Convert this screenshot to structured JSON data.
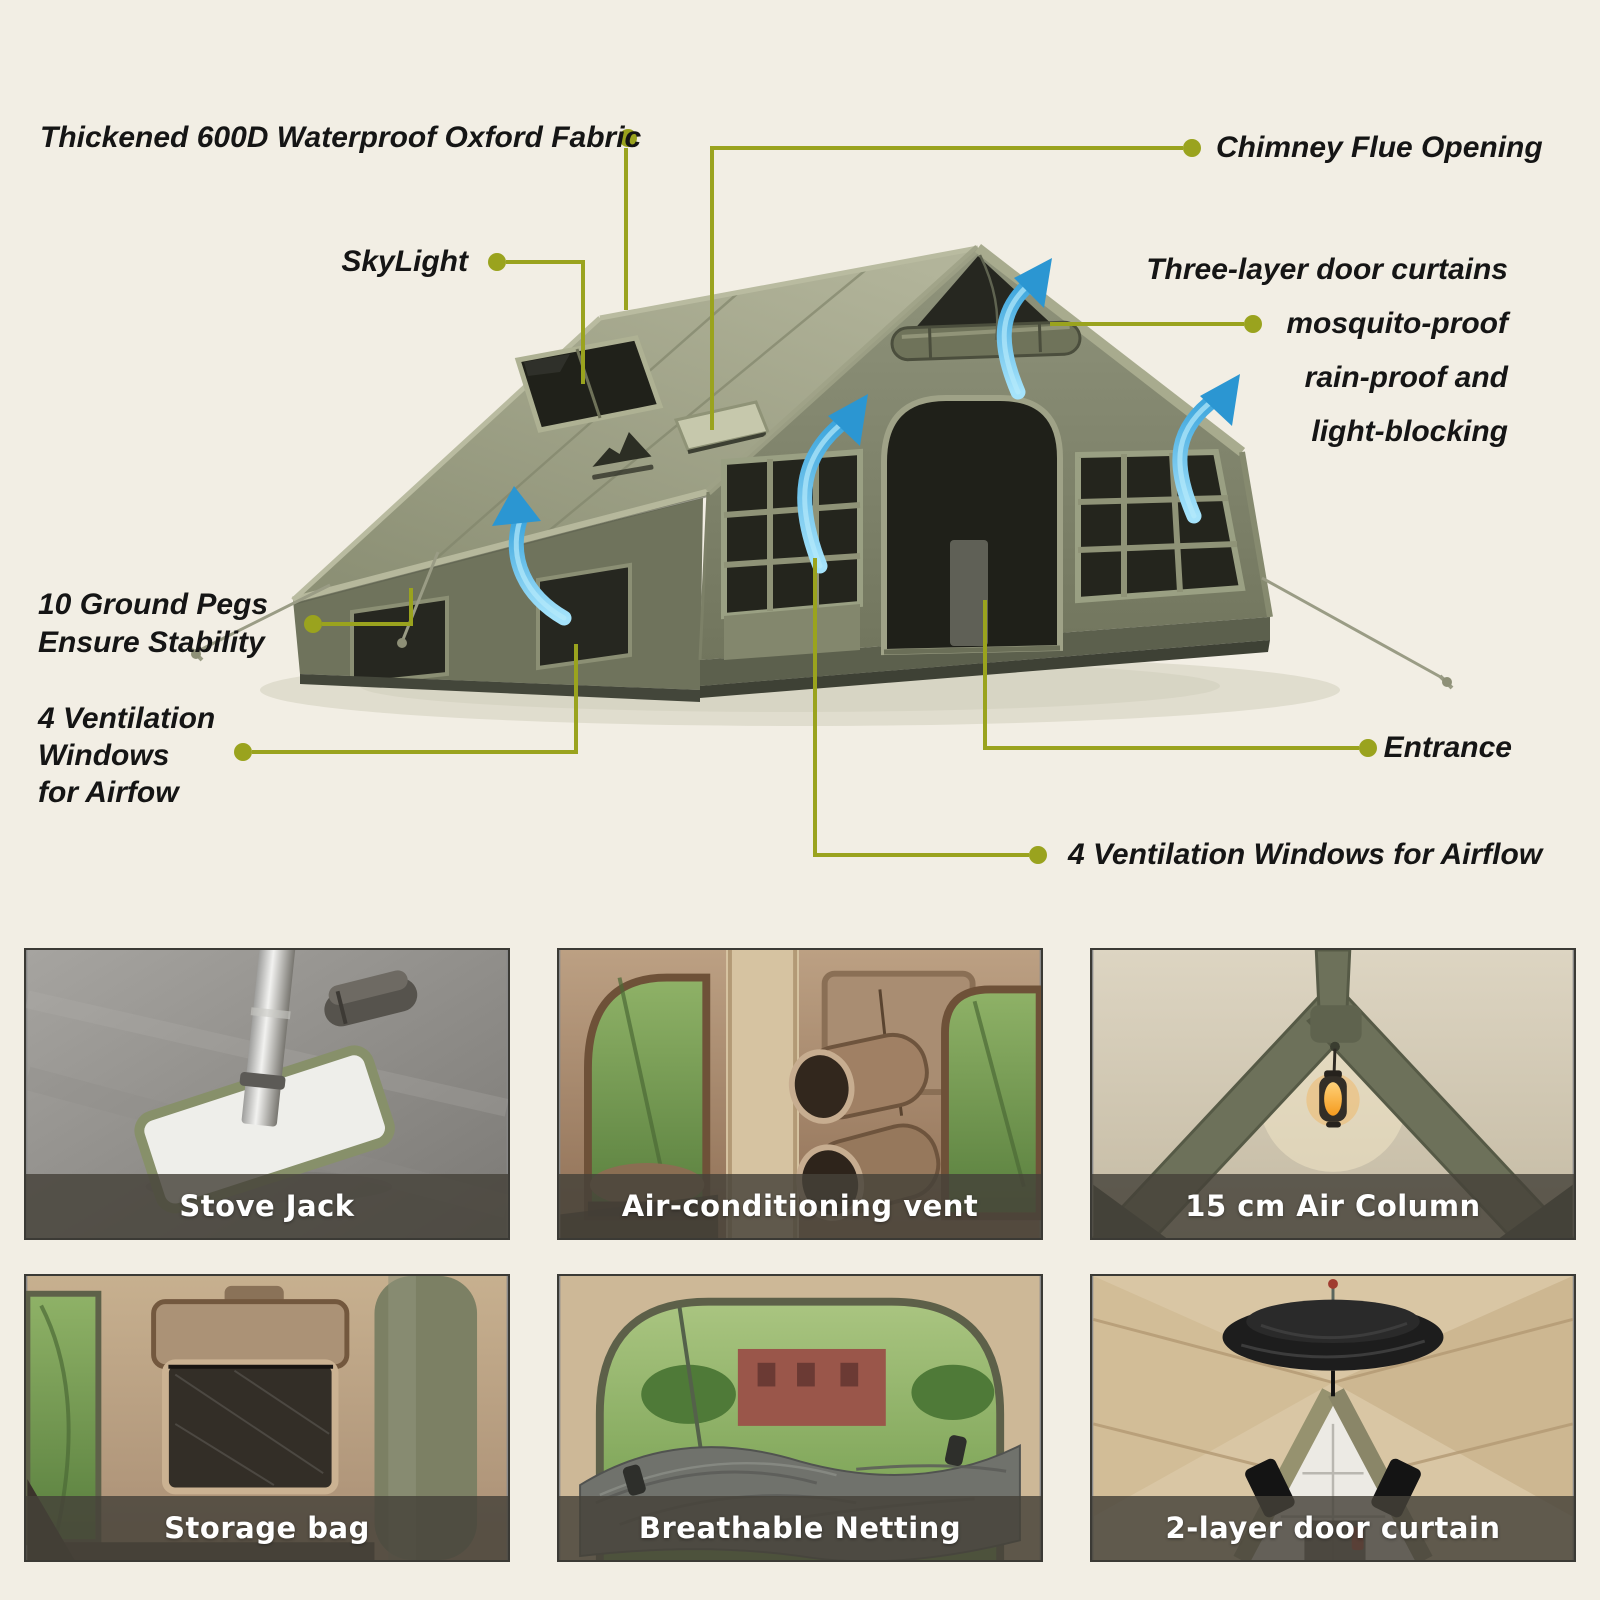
{
  "meta": {
    "background": "#f2eee4",
    "accent_line_color": "#9aa31e",
    "label_text_color": "#151515",
    "airflow_arrow_color": "#2b96d2",
    "tent_colors": {
      "roof": "#a2a58a",
      "front_face": "#82866c",
      "mesh": "#24251d",
      "trim": "#9aa083",
      "base": "#5c604d"
    }
  },
  "callouts": {
    "fabric": {
      "text": "Thickened 600D Waterproof Oxford Fabric"
    },
    "chimney": {
      "text": "Chimney Flue Opening"
    },
    "skylight": {
      "text": "SkyLight"
    },
    "door_curtains": {
      "lines": [
        "Three-layer door curtains",
        "mosquito-proof",
        "rain-proof and",
        "light-blocking"
      ]
    },
    "ground_pegs": {
      "lines": [
        "10 Ground Pegs",
        "Ensure Stability"
      ]
    },
    "vent_left": {
      "lines": [
        "4 Ventilation",
        "Windows",
        "for Airfow"
      ]
    },
    "entrance": {
      "text": "Entrance"
    },
    "vent_bottom": {
      "text": "4 Ventilation Windows for Airflow"
    }
  },
  "gallery": {
    "caption_bg": "rgba(69,66,57,0.82)",
    "caption_color": "#ffffff",
    "items": [
      {
        "caption": "Stove Jack"
      },
      {
        "caption": "Air-conditioning vent"
      },
      {
        "caption": "15 cm Air Column"
      },
      {
        "caption": "Storage bag"
      },
      {
        "caption": "Breathable Netting"
      },
      {
        "caption": "2-layer door curtain"
      }
    ]
  }
}
